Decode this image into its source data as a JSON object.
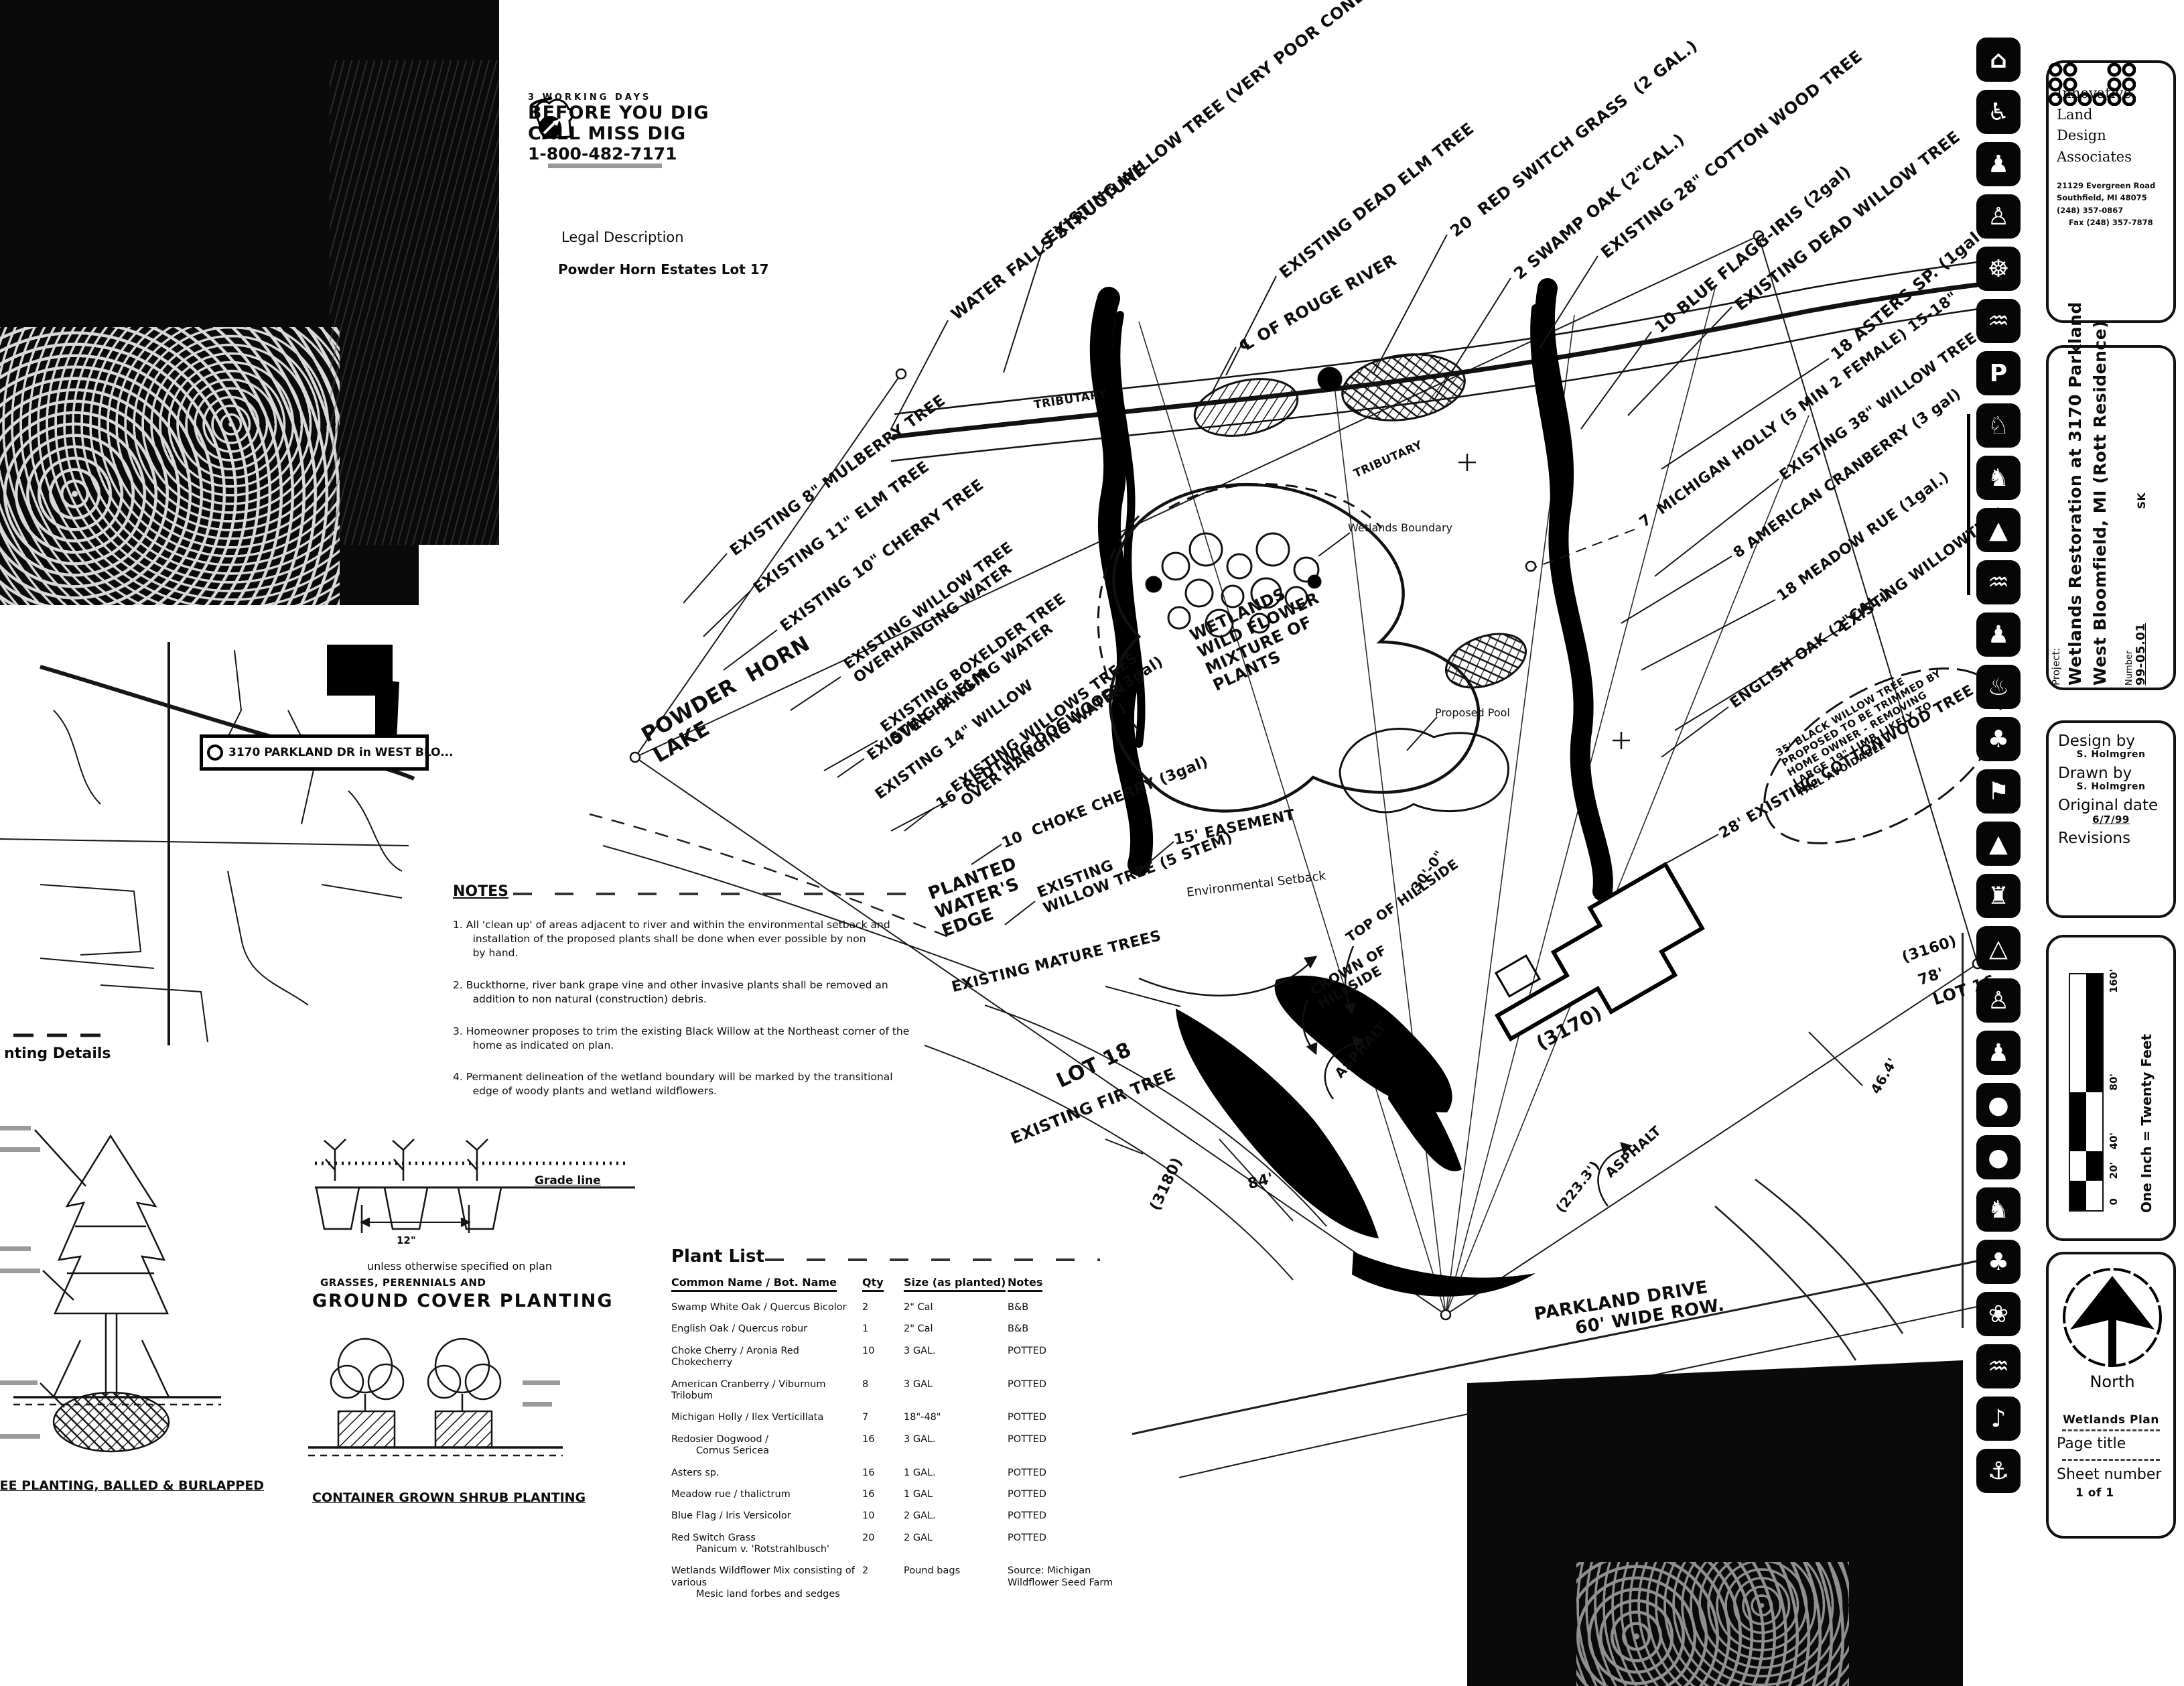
{
  "miss_dig": {
    "line1": "3 WORKING DAYS",
    "line2": "BEFORE YOU DIG",
    "line3": "CALL MISS DIG",
    "phone": "1-800-482-7171"
  },
  "legal": {
    "title": "Legal Description",
    "value": "Powder Horn Estates Lot 17"
  },
  "map": {
    "callout": "3170 PARKLAND DR in WEST BLO..."
  },
  "details": {
    "section_heading": "nting Details",
    "grade_line": "Grade line",
    "spacing": "12\"",
    "unless": "unless otherwise specified on plan",
    "grasses": "GRASSES, PERENNIALS AND",
    "ground_cover_title": "GROUND  COVER  PLANTING",
    "tree_caption": "TREE PLANTING, BALLED & BURLAPPED",
    "container_caption": "CONTAINER GROWN SHRUB PLANTING"
  },
  "notes": {
    "title": "NOTES",
    "items": [
      "1. All 'clean up' of areas adjacent to river and within the environmental setback and\n      installation of the proposed plants shall be done when ever possible by non\n      by hand.",
      "2. Buckthorne, river bank grape vine and other invasive plants shall be removed an\n      addition to non natural (construction) debris.",
      "3. Homeowner proposes to trim the existing Black Willow at the Northeast corner of the\n      home as indicated on plan.",
      "4. Permanent delineation of the wetland boundary will be marked by the transitional\n      edge of woody plants and wetland wildflowers."
    ]
  },
  "plant_list": {
    "title": "Plant List",
    "headers": {
      "name": "Common Name / Bot. Name",
      "qty": "Qty",
      "size": "Size (as planted)",
      "notes": "Notes"
    },
    "rows": [
      {
        "name": "Swamp White Oak / Quercus Bicolor",
        "qty": "2",
        "size": "2\" Cal",
        "notes": "B&B"
      },
      {
        "name": "English Oak / Quercus robur",
        "qty": "1",
        "size": "2\" Cal",
        "notes": "B&B"
      },
      {
        "name": "Choke Cherry / Aronia Red Chokecherry",
        "qty": "10",
        "size": "3 GAL.",
        "notes": "POTTED"
      },
      {
        "name": "American Cranberry / Viburnum Trilobum",
        "qty": "8",
        "size": "3 GAL",
        "notes": "POTTED"
      },
      {
        "name": "Michigan Holly / Ilex Verticillata",
        "qty": "7",
        "size": "18\"-48\"",
        "notes": "POTTED"
      },
      {
        "name": "Redosier Dogwood /\n        Cornus Sericea",
        "qty": "16",
        "size": "3 GAL.",
        "notes": "POTTED"
      },
      {
        "name": "Asters sp.",
        "qty": "16",
        "size": "1 GAL.",
        "notes": "POTTED"
      },
      {
        "name": "Meadow rue / thalictrum",
        "qty": "16",
        "size": "1 GAL",
        "notes": "POTTED"
      },
      {
        "name": "Blue Flag / Iris Versicolor",
        "qty": "10",
        "size": "2 GAL.",
        "notes": "POTTED"
      },
      {
        "name": "Red Switch Grass\n        Panicum v. 'Rotstrahlbusch'",
        "qty": "20",
        "size": "2 GAL",
        "notes": "POTTED"
      },
      {
        "name": "Wetlands Wildflower Mix consisting of various\n        Mesic land forbes and sedges",
        "qty": "2",
        "size": "Pound bags",
        "notes": "Source: Michigan\nWildflower Seed Farm"
      }
    ]
  },
  "plan": {
    "labels": [
      {
        "t": "WATER FALLS STRUCTURE"
      },
      {
        "t": "EXISTING WILLOW TREE (VERY POOR CONDITION)"
      },
      {
        "t": "EXISTING DEAD ELM TREE"
      },
      {
        "t": "℄ OF ROUGE RIVER"
      },
      {
        "t": "20  RED SWITCH GRASS  (2 GAL.)"
      },
      {
        "t": "2 SWAMP OAK (2\"CAL.)"
      },
      {
        "t": "EXISTING 28\" COTTON WOOD TREE"
      },
      {
        "t": "10 BLUE FLAGG-IRIS (2gal)"
      },
      {
        "t": "EXISTING DEAD WILLOW TREE"
      },
      {
        "t": "18 ASTERS SP. (1gal.)"
      },
      {
        "t": "TRIBUTARY"
      },
      {
        "t": "TRIBUTARY"
      },
      {
        "t": "EXISTING 8\" MULBERRY TREE"
      },
      {
        "t": "EXISTING 11\" ELM TREE"
      },
      {
        "t": "EXISTING 10\" CHERRY TREE"
      },
      {
        "t": "EXISTING WILLOW TREE\nOVERHANGING WATER"
      },
      {
        "t": "EXISTING BOXELDER TREE\nOVER HANGING WATER"
      },
      {
        "t": "EXISTING WILLOWS TREES\nOVER HANGING WATER"
      },
      {
        "t": "POWDER  HORN\nLAKE"
      },
      {
        "t": "EXISTING 9\" ELM"
      },
      {
        "t": "EXISTING 14\" WILLOW"
      },
      {
        "t": "16  REDTWIG DOGWOOD (3gal)"
      },
      {
        "t": "10  CHOKE CHERRY (3gal)"
      },
      {
        "t": "EXISTING\nWILLOW TREE (5 STEM)"
      },
      {
        "t": "PLANTED\nWATER'S\nEDGE"
      },
      {
        "t": "EXISTING MATURE TREES"
      },
      {
        "t": "7  MICHIGAN HOLLY (5 MIN 2 FEMALE) 15-18\""
      },
      {
        "t": "EXISTING 38\" WILLOW TREE"
      },
      {
        "t": "8 AMERICAN CRANBERRY (3 gal)"
      },
      {
        "t": "18 MEADOW RUE (1gal.)"
      },
      {
        "t": "EXISTING WILLOWTREE"
      },
      {
        "t": "ENGLISH OAK (2\"CAL.)"
      },
      {
        "t": "35' BLACK WILLOW TREE\nPROPOSED TO BE TRIMMED BY\nHOME OWNER - REMOVING\nLARGE 19\" LIMB LIKELY TO\nFALL AVOIDABLE"
      },
      {
        "t": "28' EXISTING COTTONWOOD TREE"
      },
      {
        "t": "WETLANDS\nWILD FLOWER\nMIXTURE OF\nPLANTS"
      },
      {
        "t": "Wetlands Boundary"
      },
      {
        "t": "Proposed Pool"
      },
      {
        "t": "15' EASEMENT"
      },
      {
        "t": "Environmental Setback"
      },
      {
        "t": "TOP OF HILLSIDE"
      },
      {
        "t": "CROWN OF\nHILLSIDE"
      },
      {
        "t": "30'-0\""
      },
      {
        "t": "LOT 18"
      },
      {
        "t": "EXISTING FIR TREE"
      },
      {
        "t": "(3180)"
      },
      {
        "t": "84'"
      },
      {
        "t": "ASPHALT"
      },
      {
        "t": "(3170)"
      },
      {
        "t": "ASPHALT"
      },
      {
        "t": "(223.3')"
      },
      {
        "t": "(3160)"
      },
      {
        "t": "78'"
      },
      {
        "t": "LOT 16"
      },
      {
        "t": "46.4'"
      },
      {
        "t": "PARKLAND DRIVE\n      60' WIDE ROW."
      }
    ]
  },
  "sidebar": {
    "icons": [
      {
        "name": "house-icon",
        "glyph": "⌂"
      },
      {
        "name": "wheelchair-icon",
        "glyph": "♿"
      },
      {
        "name": "family-icon",
        "glyph": "♟"
      },
      {
        "name": "ball-player-icon",
        "glyph": "♙"
      },
      {
        "name": "cycling-icon",
        "glyph": "☸"
      },
      {
        "name": "paddling-icon",
        "glyph": "♒"
      },
      {
        "name": "parking-icon",
        "glyph": "P"
      },
      {
        "name": "trail-icon",
        "glyph": "♘"
      },
      {
        "name": "horse-riding-icon",
        "glyph": "♞"
      },
      {
        "name": "playground-icon",
        "glyph": "▲"
      },
      {
        "name": "swimming-icon",
        "glyph": "♒"
      },
      {
        "name": "hiking-icon",
        "glyph": "♟"
      },
      {
        "name": "picnic-icon",
        "glyph": "♨"
      },
      {
        "name": "evergreens-icon",
        "glyph": "♣"
      },
      {
        "name": "golf-icon",
        "glyph": "⚑"
      },
      {
        "name": "camping-icon",
        "glyph": "▲"
      },
      {
        "name": "castle-icon",
        "glyph": "♜"
      },
      {
        "name": "seesaw-icon",
        "glyph": "△"
      },
      {
        "name": "dog-walk-icon",
        "glyph": "♙"
      },
      {
        "name": "skating-icon",
        "glyph": "♟"
      },
      {
        "name": "ballfield-icon",
        "glyph": "●"
      },
      {
        "name": "tennis-icon",
        "glyph": "●"
      },
      {
        "name": "running-icon",
        "glyph": "♞"
      },
      {
        "name": "trees-icon",
        "glyph": "♣"
      },
      {
        "name": "garden-icon",
        "glyph": "❀"
      },
      {
        "name": "waterfront-icon",
        "glyph": "♒"
      },
      {
        "name": "songbird-icon",
        "glyph": "♪"
      },
      {
        "name": "anchor-icon",
        "glyph": "⚓"
      }
    ],
    "firm": {
      "name1": "Innovative",
      "name2": "Land",
      "name3": "Design Associates",
      "addr1": "21129 Evergreen Road",
      "addr2": "Southfield, MI  48075",
      "addr3": "(248) 357-0867",
      "addr4": "Fax (248) 357-7878"
    },
    "project": {
      "label": "Project:",
      "line1": "Wetlands Restoration at 3170 Parkland",
      "line2": "West Bloomfield, MI (Rott Residence)",
      "mark": "SK",
      "number_label": "Number",
      "number": "99-05.01"
    },
    "titleblock": {
      "design_by": "Design by",
      "design_val": "S. Holmgren",
      "drawn_by": "Drawn by",
      "drawn_val": "S. Holmgren",
      "date_label": "Original date",
      "date_val": "6/7/99",
      "revisions": "Revisions"
    },
    "scale": {
      "text": "One Inch = Twenty Feet",
      "ticks": [
        "0",
        "20'",
        "40'",
        "80'",
        "160'"
      ]
    },
    "north": {
      "label": "North"
    },
    "page": {
      "title_value": "Wetlands Plan",
      "title_label": "Page title",
      "sheet_label": "Sheet number",
      "sheet_value": "1 of 1"
    }
  }
}
